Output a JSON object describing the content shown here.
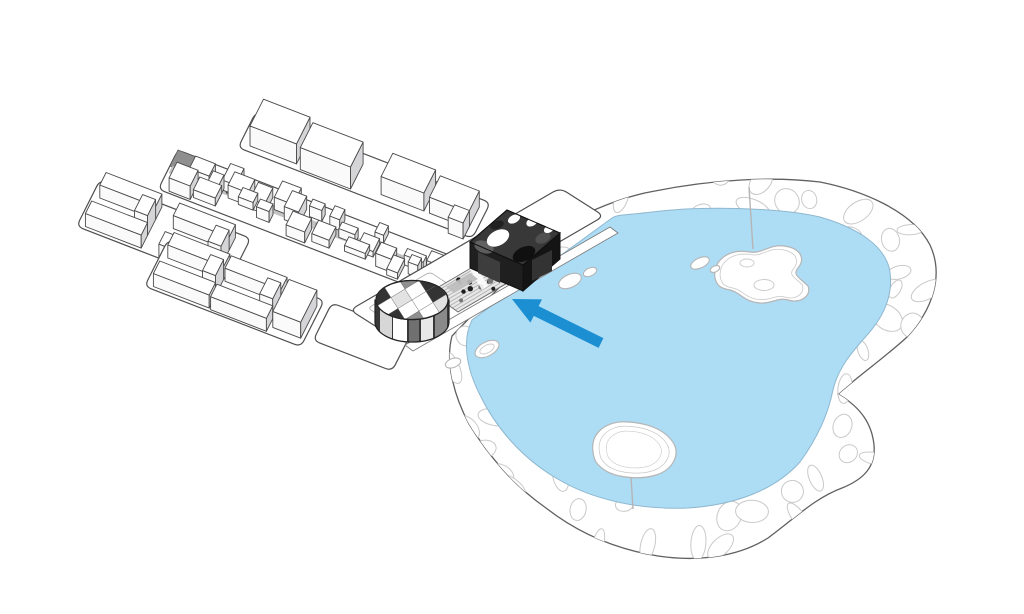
{
  "figure": {
    "kind": "architectural-axonometric-masterplan-diagram",
    "elements": {
      "park": "lakeside-park-with-organic-cells",
      "lake": "central-lake",
      "islands": [
        "north-island",
        "south-island"
      ],
      "city": "city-blocks-axonometric",
      "village": "dense-historic-village-band",
      "site": "waterfront-cultural-site-strip",
      "round_building": "checkered-cylindrical-building",
      "dark_building": "dark-block-with-round-courtyards",
      "arrow": "site-pointer-arrow"
    }
  },
  "colors": {
    "background": "#ffffff",
    "lake": "#ADDCF5",
    "water_outline": "#8FB8CF",
    "park_outline": "#606060",
    "cell_outline": "#C9C9C9",
    "island_outline": "#B5B5B5",
    "plinth_outline": "#4F4F4F",
    "building_outline": "#4A4A4A",
    "face_light": "#FAFAFA",
    "face_shade": "#D5D5D8",
    "roof": "#FFFFFF",
    "path_gray": "#BDBDBD",
    "texture_line": "#A9A9A9",
    "dark_building": "#383838",
    "dark_face": "#1F1F1F",
    "arrow": "#1B8FD2"
  }
}
